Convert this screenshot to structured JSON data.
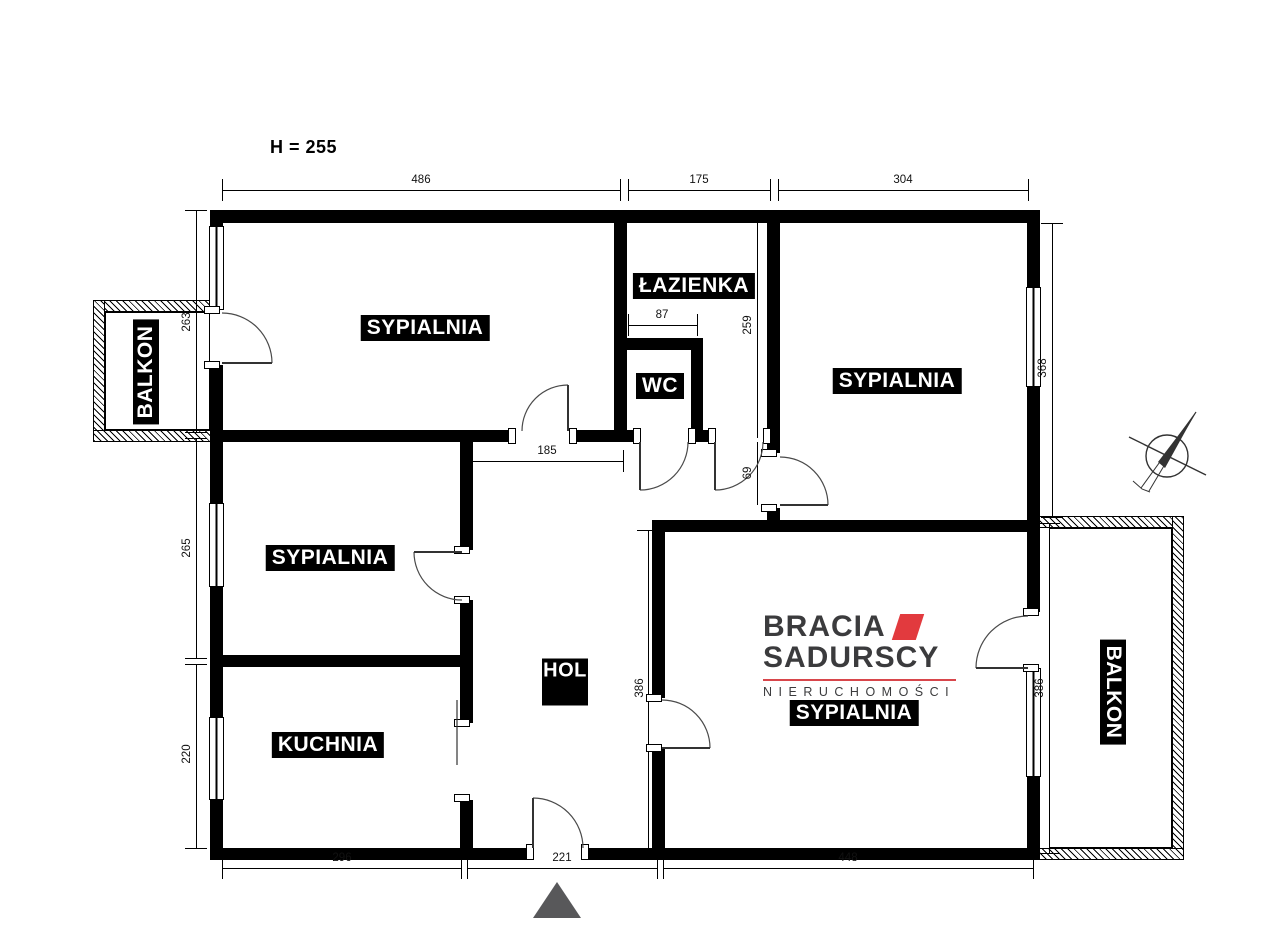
{
  "plan": {
    "ceiling_height_label": "H = 255",
    "rooms": {
      "bedroom_top_left": "SYPIALNIA",
      "bathroom": "ŁAZIENKA",
      "wc": "WC",
      "bedroom_top_right": "SYPIALNIA",
      "bedroom_mid_left": "SYPIALNIA",
      "kitchen": "KUCHNIA",
      "hall": "HOL",
      "bedroom_bottom_right": "SYPIALNIA",
      "balcony_left": "BALKON",
      "balcony_right": "BALKON"
    },
    "dimensions": {
      "top": [
        "486",
        "175",
        "304"
      ],
      "left": [
        "263",
        "265",
        "220"
      ],
      "bottom": [
        "296",
        "221",
        "448"
      ],
      "right_bedroom_height": "368",
      "balcony_right_height": "386",
      "bedroom_br_height": "386",
      "hall_width": "185",
      "wc_width": "87",
      "bathroom_height": "259",
      "passage": "69"
    },
    "colors": {
      "wall": "#000000",
      "entrance_marker": "#58585a",
      "logo_accent": "#e23a3e",
      "logo_text": "#3b3b3d"
    }
  },
  "logo": {
    "line1": "BRACIA",
    "line2": "SADURSCY",
    "line3": "NIERUCHOMOŚCI"
  }
}
